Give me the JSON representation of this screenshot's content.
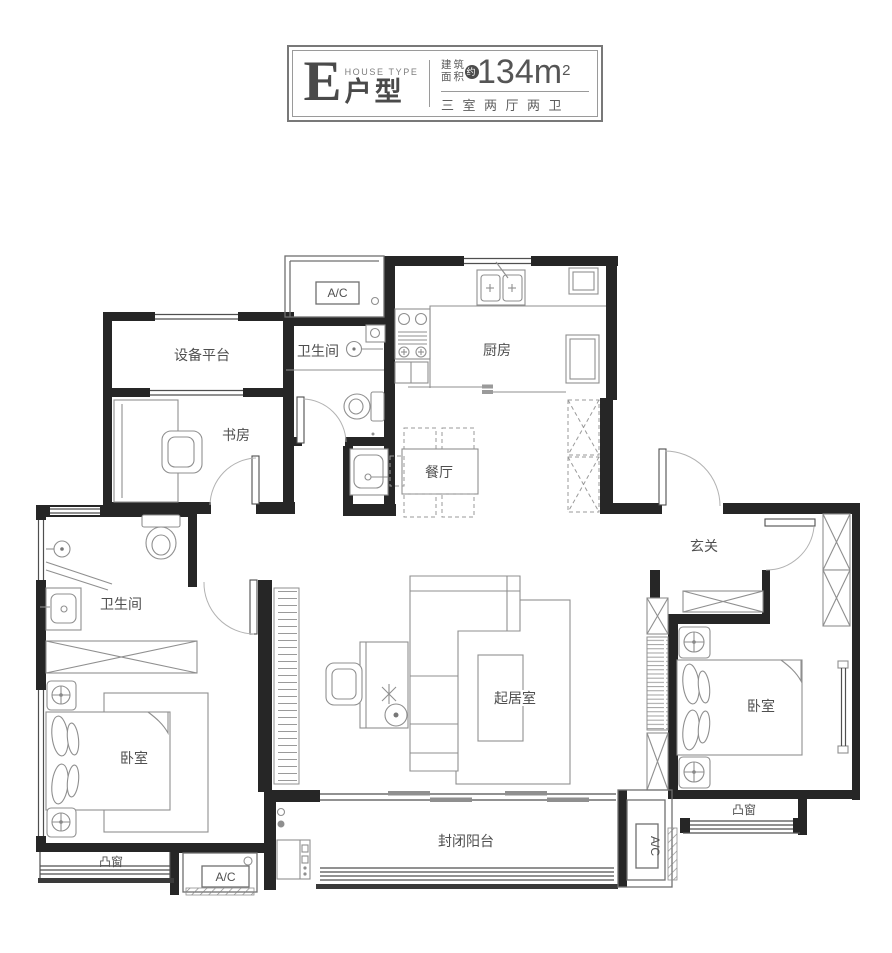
{
  "title_block": {
    "type_letter": "E",
    "type_label_en": "HOUSE TYPE",
    "type_label": "户型",
    "area_label_line1": "建筑",
    "area_label_line2": "面积",
    "area_approx": "约",
    "area_value": "134m",
    "area_sup": "2",
    "layout_spec": "三室两厅两卫"
  },
  "rooms": {
    "equipment_platform": "设备平台",
    "bathroom_top": "卫生间",
    "kitchen": "厨房",
    "study": "书房",
    "dining": "餐厅",
    "foyer": "玄关",
    "bathroom_left": "卫生间",
    "living": "起居室",
    "bedroom_left": "卧室",
    "bedroom_right": "卧室",
    "balcony": "封闭阳台",
    "bay_window_left": "凸窗",
    "bay_window_right": "凸窗"
  },
  "ac": {
    "top": "A/C",
    "bottom_left": "A/C",
    "right": "A/C"
  },
  "colors": {
    "wall": "#262626",
    "furniture_line": "#8f8f8f",
    "door_arc": "#b2b2b2",
    "text": "#4f4f4f",
    "badge_bg": "#4c4c4c",
    "title_border": "#787878"
  }
}
